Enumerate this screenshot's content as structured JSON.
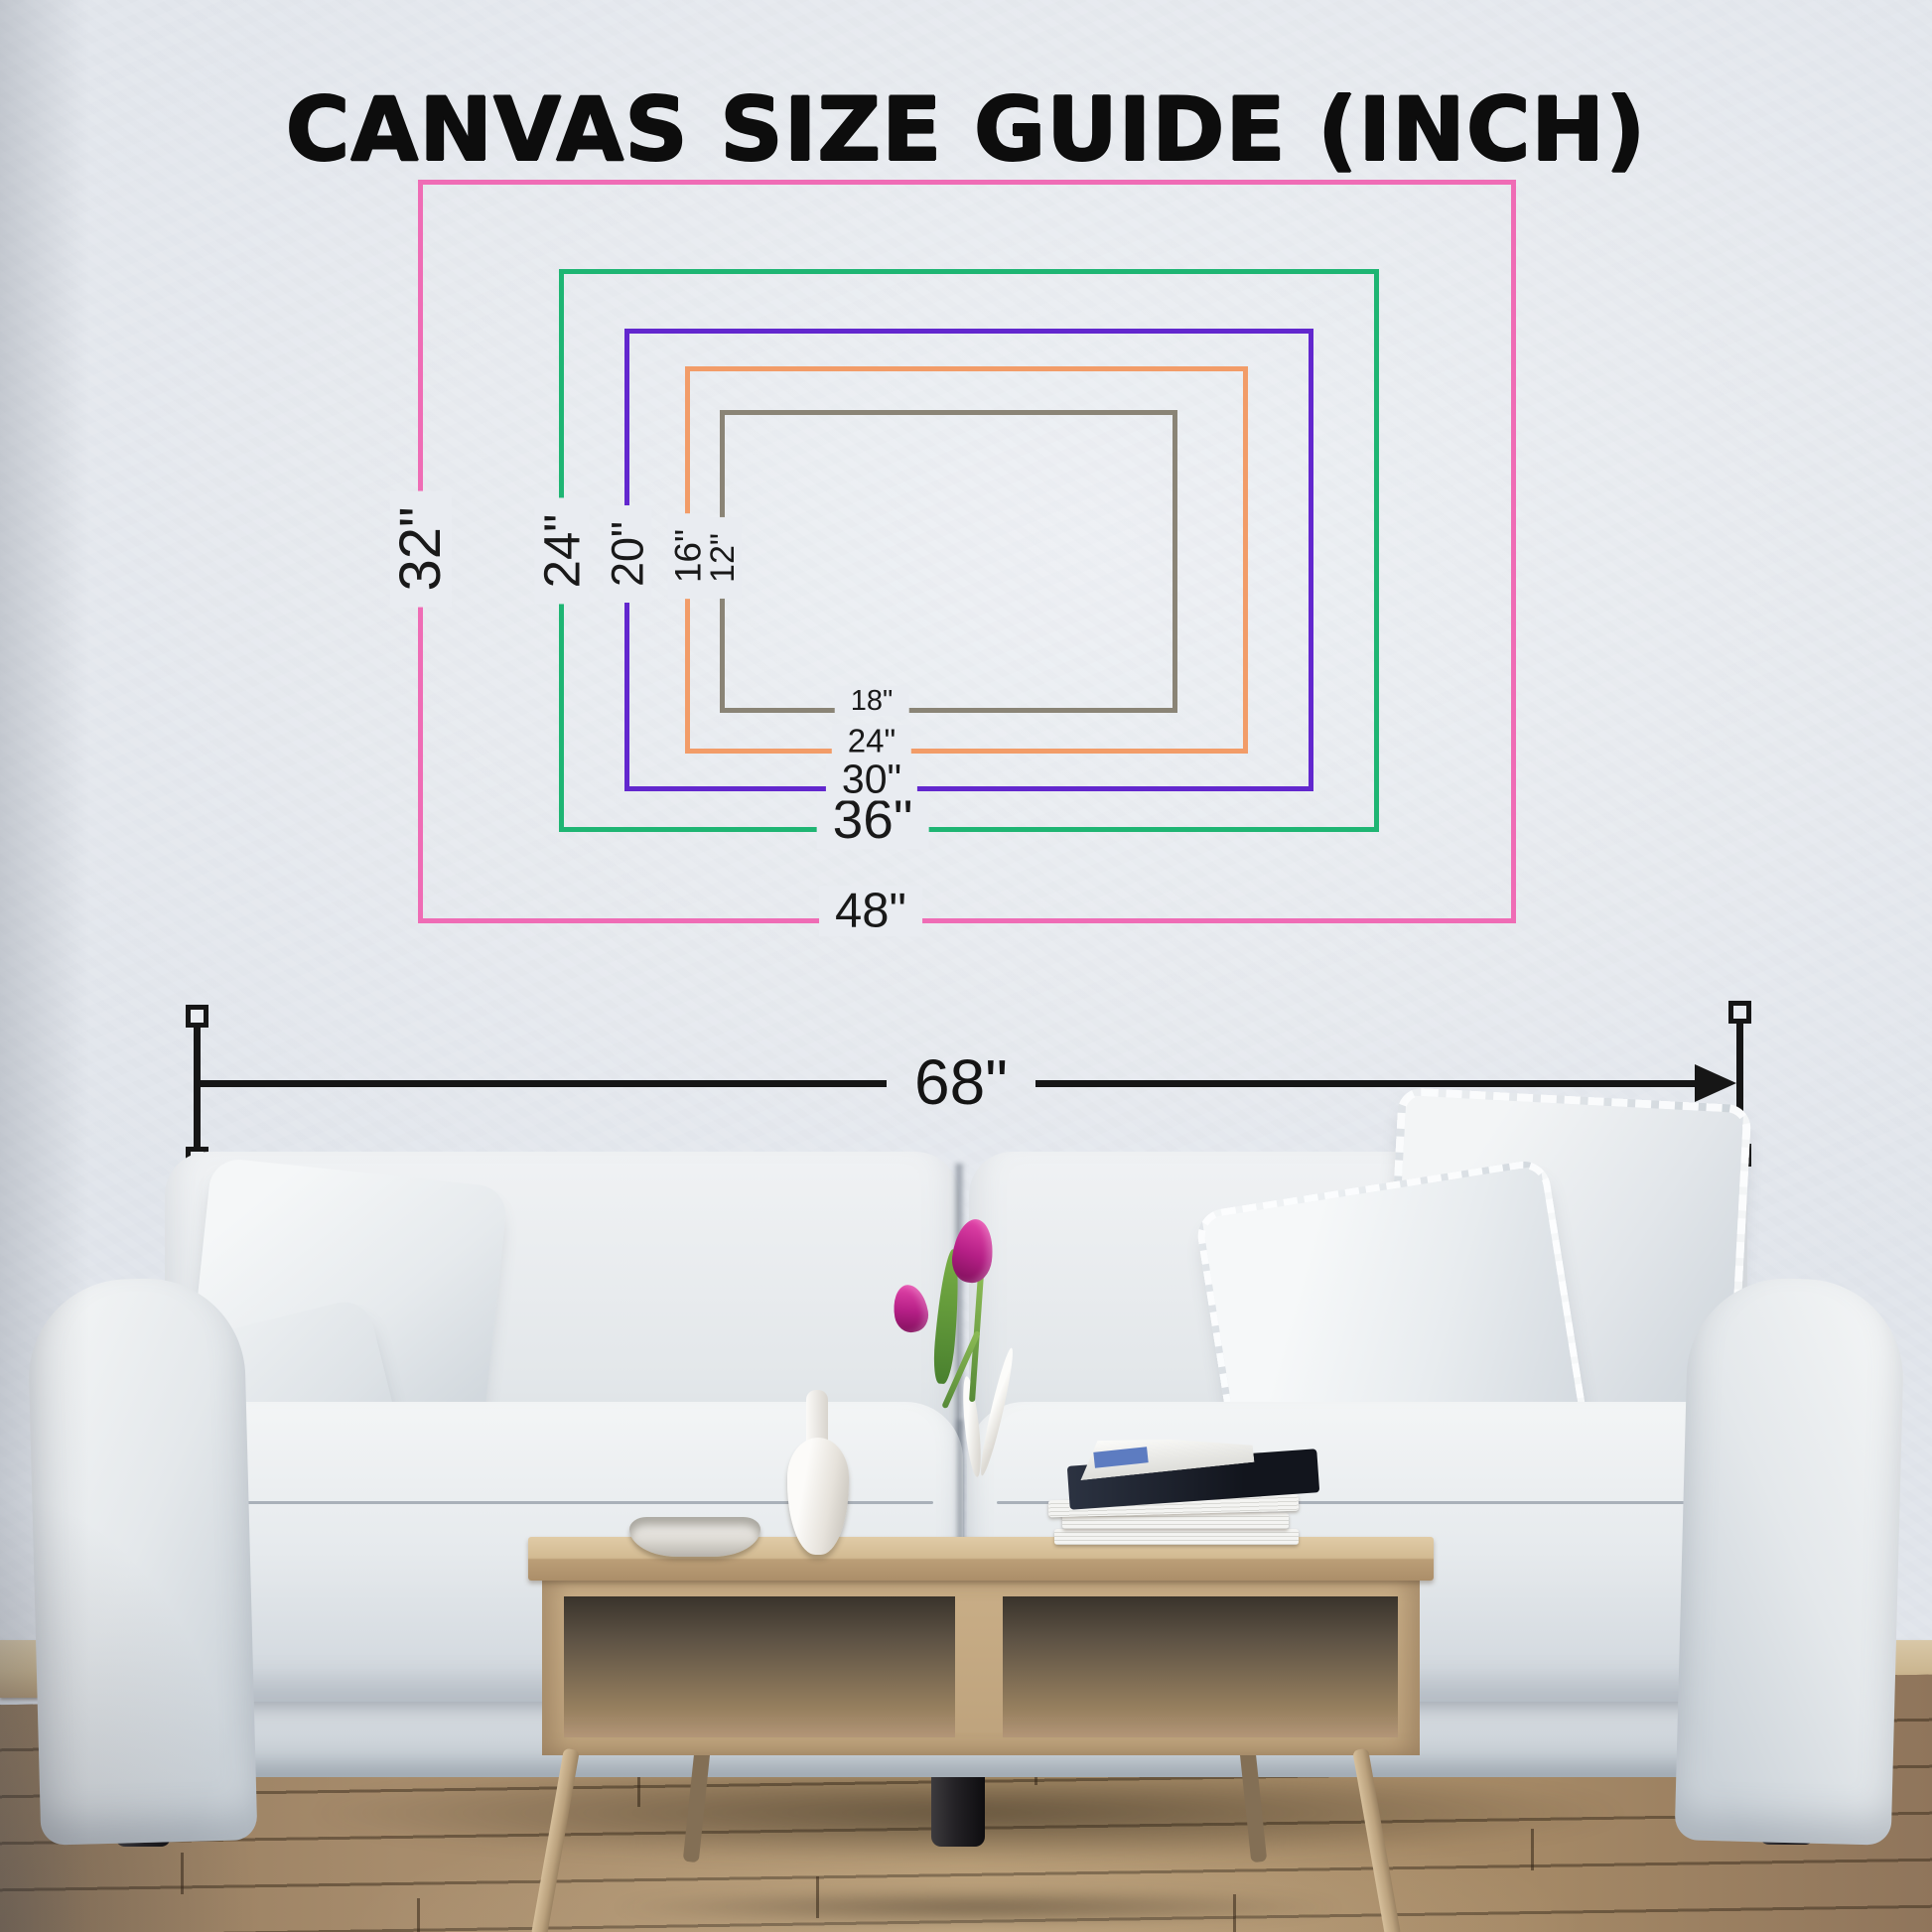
{
  "title": "CANVAS SIZE GUIDE (INCH)",
  "canvas_sizes": [
    {
      "name": "48x32",
      "bottom_label": "48\"",
      "side_label": "32\"",
      "width_in": 48,
      "height_in": 32,
      "color": "#ef6cb5",
      "color_name": "pink"
    },
    {
      "name": "36x24",
      "bottom_label": "36\"",
      "side_label": "24\"",
      "width_in": 36,
      "height_in": 24,
      "color": "#1eb573",
      "color_name": "green"
    },
    {
      "name": "30x20",
      "bottom_label": "30\"",
      "side_label": "20\"",
      "width_in": 30,
      "height_in": 20,
      "color": "#6227ce",
      "color_name": "purple"
    },
    {
      "name": "24x16",
      "bottom_label": "24\"",
      "side_label": "16\"",
      "width_in": 24,
      "height_in": 16,
      "color": "#f29c68",
      "color_name": "orange"
    },
    {
      "name": "18x12",
      "bottom_label": "18\"",
      "side_label": "12\"",
      "width_in": 18,
      "height_in": 12,
      "color": "#8a8476",
      "color_name": "gray"
    }
  ],
  "wall_dimension": {
    "label": "68\"",
    "value_in": 68
  },
  "colors": {
    "title_text": "#0d0d0d",
    "dimension": "#161616",
    "wall": "#e9ecf1"
  }
}
